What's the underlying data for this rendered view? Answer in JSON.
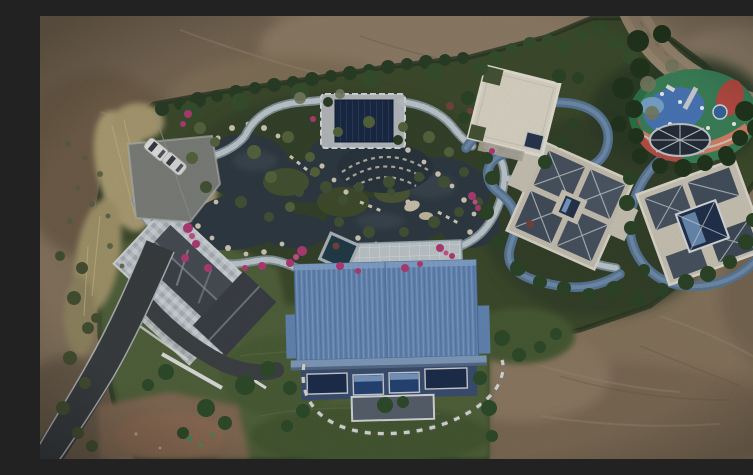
{
  "scene": {
    "description": "Aerial drone photograph of a landscaped private estate under construction: a central blue metal-roofed villa, ornamental pond with rock edging and winding stone paths, dark-roofed garden pavilion, colorful children's playground with trampoline, two slate-and-cream hip-roofed houses, a cream flat-roofed annex, a west house with mosaic patio, parking area with two white cars, curving asphalt access road, all surrounded by bare brown earth and a dirt track.",
    "text_in_image": "none",
    "objects": [
      {
        "name": "dirt-terrain",
        "label": "Bare earth surrounding the estate"
      },
      {
        "name": "dirt-road",
        "label": "Dirt track curving through top-right corner"
      },
      {
        "name": "estate-grounds",
        "label": "Green landscaped estate grounds"
      },
      {
        "name": "dry-grass",
        "label": "Tall dry yellow grass strip on west side"
      },
      {
        "name": "pond",
        "label": "Ornamental dark pond with cream rock edging"
      },
      {
        "name": "stone-paths",
        "label": "Winding light stone garden paths"
      },
      {
        "name": "jogging-track",
        "label": "Blue-grey winding jogging track"
      },
      {
        "name": "garden-pavilion",
        "label": "Dark navy-roofed garden pavilion"
      },
      {
        "name": "plunge-pool",
        "label": "Small dark plunge pool"
      },
      {
        "name": "plaza",
        "label": "Paved plaza north of main villa"
      },
      {
        "name": "main-house",
        "label": "Central villa with corrugated blue roof and glass facade"
      },
      {
        "name": "west-house",
        "label": "West house with dark gabled roof and mosaic patio"
      },
      {
        "name": "east-house-a",
        "label": "East house A with slate hip roofs and cream trim"
      },
      {
        "name": "east-house-b",
        "label": "East house B with cream flat roof and glass atrium"
      },
      {
        "name": "flat-roof-annex",
        "label": "Cream flat-roofed annex building"
      },
      {
        "name": "playground",
        "label": "Colorful children's playground"
      },
      {
        "name": "trampoline",
        "label": "In-ground trampoline with radial ropes"
      },
      {
        "name": "parking-area",
        "label": "Parking pad with two white cars"
      },
      {
        "name": "asphalt-road",
        "label": "Asphalt access road, bottom-left"
      },
      {
        "name": "driveway",
        "label": "Dark driveway spur to west house"
      },
      {
        "name": "trees",
        "label": "Evergreen trees and clipped shrubs"
      },
      {
        "name": "azalea-flowers",
        "label": "Pink azalea flower beds along paths"
      },
      {
        "name": "stepping-stones",
        "label": "Curved stepping-stone path below villa"
      }
    ],
    "colors": {
      "dirt_soil": "#8d7b64",
      "dirt_road": "#a5937a",
      "asphalt": "#3e4245",
      "estate_green": "#42502f",
      "lawn_green": "#55673e",
      "dry_grass": "#b7a97c",
      "pond_water": "#333e47",
      "stone_path": "#ccd6db",
      "track_blue": "#5f7fa2",
      "main_roof_blue": "#6e92c2",
      "pavilion_navy": "#1d2c48",
      "west_roof_gray": "#43484f",
      "east_roof_slate": "#4d5966",
      "flat_roof_cream": "#eae4d4",
      "playground_green": "#3f8a5f",
      "playground_blue": "#4f7fc4",
      "playground_salmon": "#df8a6e",
      "azalea_pink": "#bb407c",
      "tree_dark": "#2c4229",
      "car_white": "#f1f1ef",
      "rock_cream": "#ddd5bf"
    }
  }
}
